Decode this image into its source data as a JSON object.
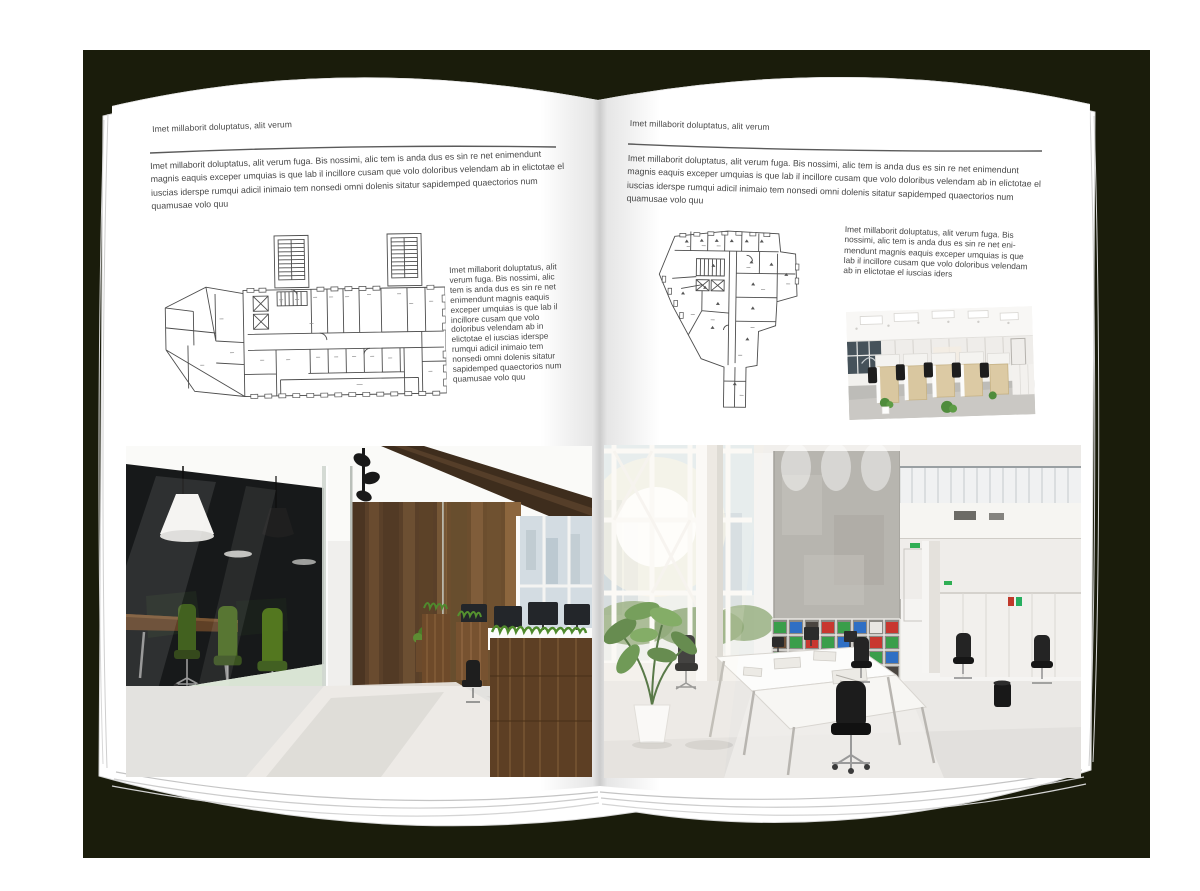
{
  "artboard": {
    "backdrop_color": "#1a1c0b",
    "page_color": "#ffffff",
    "text_color": "#474747",
    "rule_color": "#5a5a5a"
  },
  "left_page": {
    "header": "Imet millaborit doluptatus, alit verum",
    "intro": "Imet millaborit doluptatus, alit verum fuga. Bis nossimi, alic tem is anda dus es sin re net enimendunt magnis eaquis exceper umquias is que lab il incillore cusam que volo doloribus velendam ab in elictotae el iuscias iderspe rumqui adicil inimaio tem nonsedi omni dolenis sitatur sapidemped quaectorios num quamusae volo quu",
    "side_text": "Imet millaborit doluptatus, alit verum fuga. Bis nossimi, alic tem is anda dus es sin re net enimendunt magnis eaquis exceper umquias is que lab il incillore cusam que volo doloribus velendam ab in elictotae el iuscias iderspe rumqui adicil inimaio tem nonsedi omni dolenis sitatur sapidemped quaectorios num quamusae volo quu",
    "floor_plan_label": "architectural floor plan drawing",
    "photo_label": "office interior with glass meeting room, green chairs and dark wood wall"
  },
  "right_page": {
    "header": "Imet millaborit doluptatus, alit verum",
    "intro": "Imet millaborit doluptatus, alit verum fuga. Bis nossimi, alic tem is anda dus es sin re net enimendunt magnis eaquis exceper umquias is que lab il incillore cusam que volo doloribus velendam ab in elictotae el iuscias iderspe rumqui adicil inimaio tem nonsedi omni dolenis sitatur sapidemped quaectorios num quamusae volo quu",
    "side_text": "Imet millaborit doluptatus, alit verum fuga. Bis nossimi, alic tem is anda dus es sin re net eni-mendunt magnis eaquis exceper umquias is que lab il incillore cusam que volo doloribus velendam ab in elictotae el iuscias iders",
    "floor_plan_label": "architectural floor plan drawing",
    "small_photo_label": "open-plan office with rows of workstations",
    "photo_label": "bright double-height office atrium with white desks and binder shelves"
  }
}
